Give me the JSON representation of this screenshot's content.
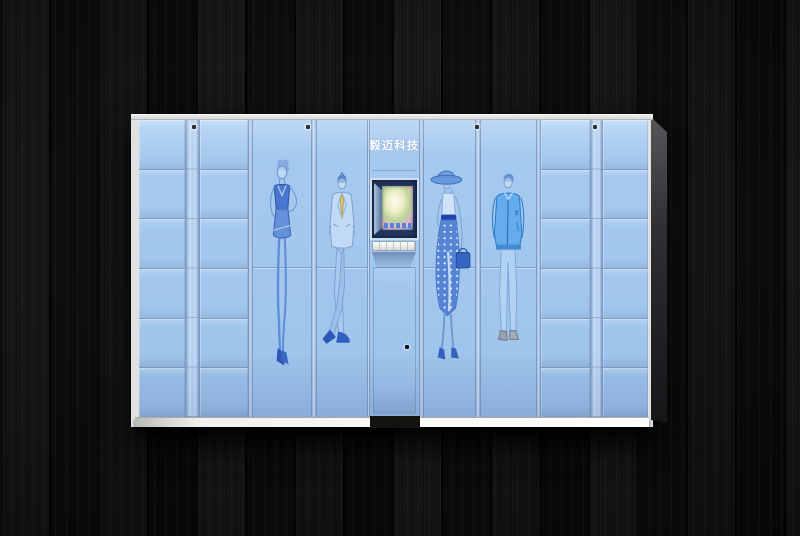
{
  "photo": {
    "scene_alt": "Light blue smart parcel locker cabinet with fashion sketch artwork, against a dark wood plank wall",
    "brand_label": "毅迈科技",
    "layout": {
      "small_column_rows": 6,
      "small_columns_left": 2,
      "small_columns_right": 2,
      "figure_doors": 4,
      "top_lock_count": 4
    },
    "artworks": [
      {
        "name": "woman-in-dress"
      },
      {
        "name": "man-in-suit"
      },
      {
        "name": "woman-with-hat"
      },
      {
        "name": "man-in-jacket"
      }
    ],
    "screen": {
      "name": "kiosk-display",
      "content": "colorful promotional image with app icon row"
    },
    "colors": {
      "panel": "#a5c9ef",
      "line": "#7e9ac2",
      "strip_light": "#cfe2f6",
      "figure": "#4a7ed2",
      "figure_dark": "#2f5cb8",
      "figure_light": "#c6dcf6",
      "tie": "#d8c67c",
      "jacket": "#5ea9ec",
      "jeans": "#b2d2f4",
      "screen_frame": "#22365f",
      "frame_white": "#eceeea",
      "side": "#3a3b3e",
      "wood": "#121110",
      "lock": "#141414"
    }
  }
}
